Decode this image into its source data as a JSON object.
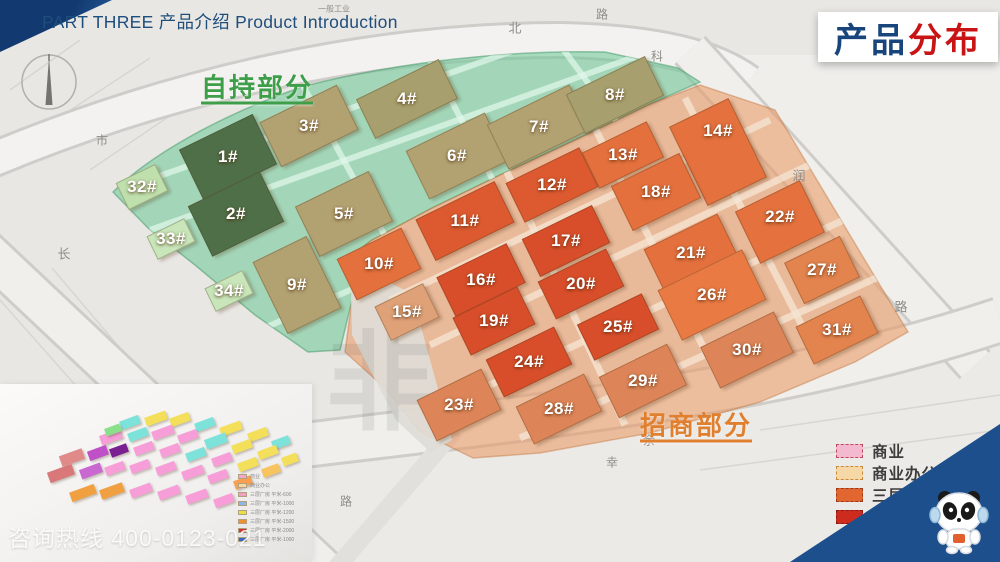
{
  "header": {
    "part_label": "PART THREE 产品介绍 Product Introduction"
  },
  "title": {
    "text_blue": "产品",
    "text_red": "分布",
    "blue_color": "#17457c",
    "red_color": "#c81414"
  },
  "regions": {
    "self_hold": {
      "label": "自持部分",
      "color": "#3f9e4a",
      "x": 257,
      "y": 86
    },
    "investment": {
      "label": "招商部分",
      "color": "#e07f2e",
      "x": 696,
      "y": 424
    }
  },
  "map": {
    "watermark": "非",
    "overlay_colors": {
      "self_hold": "rgba(105,200,150,0.55)",
      "investment": "rgba(233,150,94,0.55)"
    },
    "road_labels": [
      {
        "text": "一般工业",
        "x": 334,
        "y": 9,
        "size": 8
      },
      {
        "text": "北",
        "x": 515,
        "y": 27,
        "size": 13
      },
      {
        "text": "路",
        "x": 602,
        "y": 14,
        "size": 12
      },
      {
        "text": "科",
        "x": 657,
        "y": 56,
        "size": 12
      },
      {
        "text": "润",
        "x": 799,
        "y": 175,
        "size": 13
      },
      {
        "text": "路",
        "x": 901,
        "y": 306,
        "size": 13
      },
      {
        "text": "市",
        "x": 102,
        "y": 140,
        "size": 12
      },
      {
        "text": "长",
        "x": 64,
        "y": 253,
        "size": 13
      },
      {
        "text": "路",
        "x": 346,
        "y": 501,
        "size": 12
      },
      {
        "text": "幸",
        "x": 612,
        "y": 462,
        "size": 12
      },
      {
        "text": "余",
        "x": 649,
        "y": 440,
        "size": 12
      }
    ],
    "buildings": [
      {
        "id": "1",
        "label": "1#",
        "x": 228,
        "y": 157,
        "w": 82,
        "h": 56,
        "rot": -26,
        "color": "#4f6f48"
      },
      {
        "id": "2",
        "label": "2#",
        "x": 236,
        "y": 214,
        "w": 80,
        "h": 56,
        "rot": -26,
        "color": "#4f6f48"
      },
      {
        "id": "3",
        "label": "3#",
        "x": 309,
        "y": 126,
        "w": 86,
        "h": 50,
        "rot": -26,
        "color": "#b2a171"
      },
      {
        "id": "4",
        "label": "4#",
        "x": 407,
        "y": 99,
        "w": 92,
        "h": 44,
        "rot": -26,
        "color": "#a79f6d"
      },
      {
        "id": "5",
        "label": "5#",
        "x": 344,
        "y": 214,
        "w": 82,
        "h": 56,
        "rot": -26,
        "color": "#b2a171"
      },
      {
        "id": "6",
        "label": "6#",
        "x": 457,
        "y": 156,
        "w": 88,
        "h": 54,
        "rot": -26,
        "color": "#b2a171"
      },
      {
        "id": "7",
        "label": "7#",
        "x": 539,
        "y": 127,
        "w": 92,
        "h": 50,
        "rot": -26,
        "color": "#b2a171"
      },
      {
        "id": "8",
        "label": "8#",
        "x": 615,
        "y": 95,
        "w": 88,
        "h": 44,
        "rot": -26,
        "color": "#a79f6d"
      },
      {
        "id": "9",
        "label": "9#",
        "x": 297,
        "y": 285,
        "w": 60,
        "h": 80,
        "rot": -26,
        "color": "#b2a171"
      },
      {
        "id": "32",
        "label": "32#",
        "x": 142,
        "y": 187,
        "w": 44,
        "h": 30,
        "rot": -26,
        "color": "#bfe0ad"
      },
      {
        "id": "33",
        "label": "33#",
        "x": 171,
        "y": 239,
        "w": 42,
        "h": 26,
        "rot": -26,
        "color": "#c8e6ba"
      },
      {
        "id": "34",
        "label": "34#",
        "x": 229,
        "y": 291,
        "w": 42,
        "h": 26,
        "rot": -26,
        "color": "#c8e6ba"
      },
      {
        "id": "10",
        "label": "10#",
        "x": 379,
        "y": 264,
        "w": 72,
        "h": 46,
        "rot": -26,
        "color": "#e4703d"
      },
      {
        "id": "11",
        "label": "11#",
        "x": 465,
        "y": 221,
        "w": 88,
        "h": 46,
        "rot": -26,
        "color": "#dd5a30"
      },
      {
        "id": "12",
        "label": "12#",
        "x": 552,
        "y": 185,
        "w": 82,
        "h": 44,
        "rot": -26,
        "color": "#dd5a30"
      },
      {
        "id": "13",
        "label": "13#",
        "x": 623,
        "y": 155,
        "w": 72,
        "h": 40,
        "rot": -26,
        "color": "#e4703d"
      },
      {
        "id": "14",
        "label": "14#",
        "x": 718,
        "y": 152,
        "w": 66,
        "h": 88,
        "rot": -26,
        "ly": 131,
        "color": "#e4713e"
      },
      {
        "id": "15",
        "label": "15#",
        "x": 407,
        "y": 312,
        "w": 54,
        "h": 38,
        "rot": -26,
        "color": "#dfa177"
      },
      {
        "id": "16",
        "label": "16#",
        "x": 481,
        "y": 280,
        "w": 78,
        "h": 44,
        "rot": -26,
        "color": "#d84e2a"
      },
      {
        "id": "17",
        "label": "17#",
        "x": 566,
        "y": 241,
        "w": 78,
        "h": 42,
        "rot": -26,
        "color": "#d84e2a"
      },
      {
        "id": "18",
        "label": "18#",
        "x": 656,
        "y": 192,
        "w": 76,
        "h": 50,
        "rot": -26,
        "color": "#e4703d"
      },
      {
        "id": "19",
        "label": "19#",
        "x": 494,
        "y": 321,
        "w": 72,
        "h": 42,
        "rot": -26,
        "color": "#d84e2a"
      },
      {
        "id": "20",
        "label": "20#",
        "x": 581,
        "y": 284,
        "w": 76,
        "h": 42,
        "rot": -26,
        "color": "#d84e2a"
      },
      {
        "id": "21",
        "label": "21#",
        "x": 691,
        "y": 253,
        "w": 82,
        "h": 48,
        "rot": -26,
        "color": "#e4703d"
      },
      {
        "id": "22",
        "label": "22#",
        "x": 780,
        "y": 222,
        "w": 72,
        "h": 58,
        "rot": -26,
        "ly": 217,
        "color": "#e4713e"
      },
      {
        "id": "23",
        "label": "23#",
        "x": 459,
        "y": 405,
        "w": 72,
        "h": 46,
        "rot": -26,
        "color": "#dd8558"
      },
      {
        "id": "24",
        "label": "24#",
        "x": 529,
        "y": 362,
        "w": 76,
        "h": 42,
        "rot": -26,
        "color": "#d84e2a"
      },
      {
        "id": "25",
        "label": "25#",
        "x": 618,
        "y": 327,
        "w": 72,
        "h": 40,
        "rot": -26,
        "color": "#d84e2a"
      },
      {
        "id": "26",
        "label": "26#",
        "x": 712,
        "y": 295,
        "w": 94,
        "h": 56,
        "rot": -26,
        "color": "#ea7a44"
      },
      {
        "id": "27",
        "label": "27#",
        "x": 822,
        "y": 270,
        "w": 62,
        "h": 46,
        "rot": -26,
        "color": "#e3834e"
      },
      {
        "id": "28",
        "label": "28#",
        "x": 559,
        "y": 409,
        "w": 76,
        "h": 42,
        "rot": -26,
        "color": "#dd8558"
      },
      {
        "id": "29",
        "label": "29#",
        "x": 643,
        "y": 381,
        "w": 76,
        "h": 46,
        "rot": -26,
        "color": "#dd8558"
      },
      {
        "id": "30",
        "label": "30#",
        "x": 747,
        "y": 350,
        "w": 82,
        "h": 46,
        "rot": -26,
        "color": "#dd8558"
      },
      {
        "id": "31",
        "label": "31#",
        "x": 837,
        "y": 330,
        "w": 72,
        "h": 42,
        "rot": -26,
        "color": "#e3834e"
      }
    ]
  },
  "legend": {
    "items": [
      {
        "label": "商业",
        "color": "#f3b9ce",
        "border": "#c2485f"
      },
      {
        "label": "商业办公",
        "color": "#f5d8a6",
        "border": "#c78a3b"
      },
      {
        "label": "三层厂房",
        "color": "#e2662f",
        "border": "#9c3a1a"
      },
      {
        "label": "四层厂房",
        "color": "#cd2b1e",
        "border": "#8a1a12"
      },
      {
        "label": "五层厂房",
        "color": "#8a4e3c",
        "border": "#5f3328"
      },
      {
        "label": "七层厂房",
        "color": "#4a0d0f",
        "border": "#3a0a0c"
      }
    ]
  },
  "inset": {
    "mini_legend": [
      {
        "color": "#f2a8c8",
        "label": "商业"
      },
      {
        "color": "#f5d8a6",
        "label": "商业办公"
      },
      {
        "color": "#f0a0c0",
        "label": "三层厂房 平米-600"
      },
      {
        "color": "#88b8e8",
        "label": "三层厂房 平米-1000"
      },
      {
        "color": "#e8e040",
        "label": "三层厂房 平米-1200"
      },
      {
        "color": "#f09030",
        "label": "三层厂房 平米-1500"
      },
      {
        "color": "#d03028",
        "label": "三层厂房 平米-2000"
      },
      {
        "color": "#3868c0",
        "label": "三层厂房 平米-1000"
      }
    ],
    "blocks": [
      [
        120,
        34,
        20,
        9,
        "#7de2da"
      ],
      [
        145,
        30,
        22,
        9,
        "#f3df5a"
      ],
      [
        170,
        31,
        20,
        9,
        "#f3df5a"
      ],
      [
        195,
        36,
        20,
        9,
        "#7de2da"
      ],
      [
        220,
        40,
        22,
        9,
        "#f3df5a"
      ],
      [
        248,
        46,
        20,
        9,
        "#f3df5a"
      ],
      [
        272,
        54,
        18,
        9,
        "#7de2da"
      ],
      [
        100,
        48,
        22,
        10,
        "#f79ed8"
      ],
      [
        128,
        46,
        20,
        9,
        "#7de2da"
      ],
      [
        152,
        44,
        22,
        9,
        "#f79ed8"
      ],
      [
        178,
        48,
        20,
        9,
        "#f79ed8"
      ],
      [
        205,
        52,
        22,
        10,
        "#7de2da"
      ],
      [
        232,
        58,
        20,
        9,
        "#f3df5a"
      ],
      [
        258,
        64,
        20,
        9,
        "#f3df5a"
      ],
      [
        282,
        71,
        16,
        9,
        "#f3df5a"
      ],
      [
        60,
        68,
        24,
        11,
        "#e08a8a"
      ],
      [
        88,
        64,
        20,
        10,
        "#c050c8"
      ],
      [
        110,
        62,
        18,
        9,
        "#7a2090"
      ],
      [
        134,
        60,
        20,
        9,
        "#f79ed8"
      ],
      [
        160,
        62,
        20,
        9,
        "#f79ed8"
      ],
      [
        186,
        66,
        20,
        9,
        "#7de2da"
      ],
      [
        212,
        71,
        20,
        9,
        "#f79ed8"
      ],
      [
        238,
        76,
        20,
        9,
        "#f3df5a"
      ],
      [
        262,
        82,
        18,
        9,
        "#f8c460"
      ],
      [
        48,
        84,
        26,
        11,
        "#d87878"
      ],
      [
        80,
        82,
        22,
        10,
        "#c868d0"
      ],
      [
        105,
        80,
        20,
        9,
        "#f79ed8"
      ],
      [
        130,
        78,
        20,
        9,
        "#f79ed8"
      ],
      [
        156,
        80,
        20,
        9,
        "#f79ed8"
      ],
      [
        182,
        84,
        22,
        9,
        "#f79ed8"
      ],
      [
        208,
        88,
        20,
        9,
        "#f79ed8"
      ],
      [
        234,
        94,
        18,
        9,
        "#f8a050"
      ],
      [
        70,
        104,
        26,
        10,
        "#f0a040"
      ],
      [
        100,
        102,
        24,
        10,
        "#f0a040"
      ],
      [
        130,
        102,
        22,
        9,
        "#f79ed8"
      ],
      [
        158,
        104,
        22,
        9,
        "#f79ed8"
      ],
      [
        186,
        108,
        22,
        9,
        "#f79ed8"
      ],
      [
        214,
        112,
        20,
        9,
        "#f79ed8"
      ],
      [
        105,
        42,
        16,
        8,
        "#8ae08a"
      ]
    ]
  },
  "footer": {
    "hotline": "咨询热线 400-0123-021"
  },
  "mascot": {
    "icon": "panda-mascot"
  }
}
